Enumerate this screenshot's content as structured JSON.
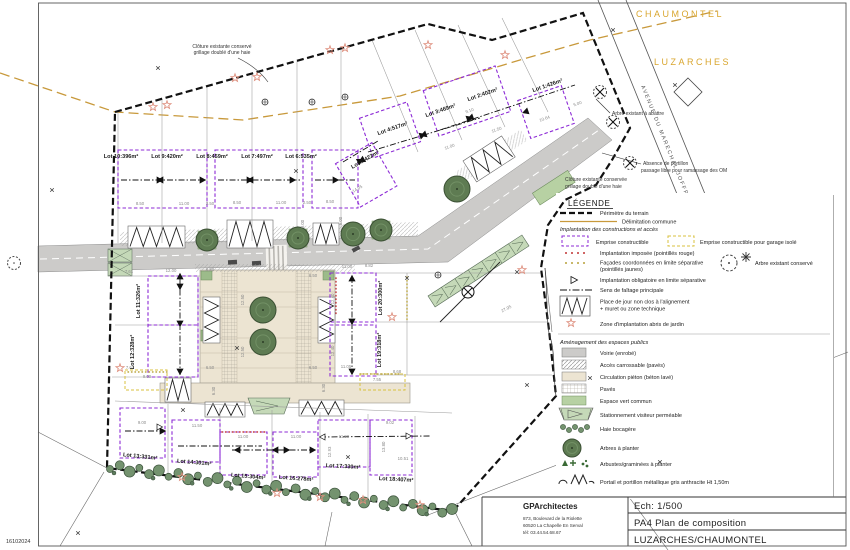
{
  "map": {
    "communes": {
      "north": "CHAUMONTEL",
      "south": "LUZARCHES"
    },
    "street": "AVENUE DU MARECHAL JOFFRE",
    "date_stamp": "16102024",
    "annotations": {
      "fence_nw_1": "Clôture existante conservé",
      "fence_nw_2": "grillage doublé d'une haie",
      "tree_fell": "Arbre existant à abattre",
      "bins_1": "Absence de portillon",
      "bins_2": "passage libre pour ramassage des OM",
      "fence_ne_1": "Clôture existante conservée",
      "fence_ne_2": "grillage doublé d'une haie"
    },
    "lots": [
      {
        "label": "Lot 1:426m²",
        "x": 548,
        "y": 87,
        "rot": -19
      },
      {
        "label": "Lot 2:402m²",
        "x": 483,
        "y": 96,
        "rot": -19
      },
      {
        "label": "Lot 3:469m²",
        "x": 441,
        "y": 112,
        "rot": -19
      },
      {
        "label": "Lot 4:517m²",
        "x": 393,
        "y": 130,
        "rot": -19
      },
      {
        "label": "Lot 5:422m²",
        "x": 366,
        "y": 161,
        "rot": -30
      },
      {
        "label": "Lot 6:535m²",
        "x": 301,
        "y": 158,
        "rot": 0
      },
      {
        "label": "Lot 7:497m²",
        "x": 257,
        "y": 158,
        "rot": 0
      },
      {
        "label": "Lot 8:459m²",
        "x": 212,
        "y": 158,
        "rot": 0
      },
      {
        "label": "Lot 9:420m²",
        "x": 167,
        "y": 158,
        "rot": 0
      },
      {
        "label": "Lot 10:396m²",
        "x": 121,
        "y": 158,
        "rot": 0
      },
      {
        "label": "Lot 11:326m²",
        "x": 140,
        "y": 301,
        "rot": -90
      },
      {
        "label": "Lot 12:328m²",
        "x": 134,
        "y": 352,
        "rot": -90
      },
      {
        "label": "Lot 13:331m²",
        "x": 140,
        "y": 458,
        "rot": 6
      },
      {
        "label": "Lot 14:301m²",
        "x": 194,
        "y": 464,
        "rot": 5
      },
      {
        "label": "Lot 15:304m²",
        "x": 248,
        "y": 478,
        "rot": 5
      },
      {
        "label": "Lot 16:278m²",
        "x": 296,
        "y": 480,
        "rot": 4
      },
      {
        "label": "Lot 17:330m²",
        "x": 343,
        "y": 468,
        "rot": 3
      },
      {
        "label": "Lot 18:407m²",
        "x": 396,
        "y": 481,
        "rot": 3
      },
      {
        "label": "Lot 19:318m²",
        "x": 381,
        "y": 350,
        "rot": -90
      },
      {
        "label": "Lot 20:300m²",
        "x": 382,
        "y": 298,
        "rot": -90
      }
    ],
    "dimensions": [
      {
        "t": "8.50",
        "x": 140,
        "y": 205
      },
      {
        "t": "11.00",
        "x": 184,
        "y": 205
      },
      {
        "t": "2.50",
        "x": 210,
        "y": 205
      },
      {
        "t": "8.50",
        "x": 237,
        "y": 204
      },
      {
        "t": "11.00",
        "x": 281,
        "y": 204
      },
      {
        "t": "2.50",
        "x": 307,
        "y": 204
      },
      {
        "t": "8.50",
        "x": 330,
        "y": 203
      },
      {
        "t": "5.00",
        "x": 304,
        "y": 224,
        "r": -90
      },
      {
        "t": "5.00",
        "x": 342,
        "y": 221,
        "r": -90
      },
      {
        "t": "11.00",
        "x": 450,
        "y": 148,
        "r": -19
      },
      {
        "t": "11.50",
        "x": 497,
        "y": 131,
        "r": -19
      },
      {
        "t": "9.10",
        "x": 470,
        "y": 112,
        "r": -19
      },
      {
        "t": "10.64",
        "x": 545,
        "y": 120,
        "r": -19
      },
      {
        "t": "14.05",
        "x": 358,
        "y": 190,
        "r": -30
      },
      {
        "t": "5.00",
        "x": 578,
        "y": 105,
        "r": -19
      },
      {
        "t": "7.61",
        "x": 129,
        "y": 273
      },
      {
        "t": "12.00",
        "x": 171,
        "y": 272
      },
      {
        "t": "6.50",
        "x": 210,
        "y": 271
      },
      {
        "t": "12.50",
        "x": 244,
        "y": 300,
        "r": -90
      },
      {
        "t": "12.50",
        "x": 244,
        "y": 352,
        "r": -90
      },
      {
        "t": "6.50",
        "x": 210,
        "y": 369
      },
      {
        "t": "7.61",
        "x": 130,
        "y": 369
      },
      {
        "t": "9.00",
        "x": 147,
        "y": 378
      },
      {
        "t": "6.30",
        "x": 215,
        "y": 391,
        "r": -90
      },
      {
        "t": "11.00",
        "x": 347,
        "y": 268
      },
      {
        "t": "8.82",
        "x": 369,
        "y": 267
      },
      {
        "t": "12.40",
        "x": 334,
        "y": 299,
        "r": -90
      },
      {
        "t": "12.40",
        "x": 334,
        "y": 351,
        "r": -90
      },
      {
        "t": "11.05",
        "x": 346,
        "y": 368
      },
      {
        "t": "7.55",
        "x": 377,
        "y": 381
      },
      {
        "t": "8.68",
        "x": 397,
        "y": 373
      },
      {
        "t": "27.95",
        "x": 507,
        "y": 310,
        "r": -28
      },
      {
        "t": "6.50",
        "x": 313,
        "y": 277
      },
      {
        "t": "6.50",
        "x": 313,
        "y": 369
      },
      {
        "t": "6.30",
        "x": 325,
        "y": 388,
        "r": -90
      },
      {
        "t": "9.00",
        "x": 142,
        "y": 424
      },
      {
        "t": "11.50",
        "x": 197,
        "y": 427
      },
      {
        "t": "11.00",
        "x": 243,
        "y": 438
      },
      {
        "t": "11.00",
        "x": 296,
        "y": 438
      },
      {
        "t": "11.99",
        "x": 344,
        "y": 438
      },
      {
        "t": "9.02",
        "x": 390,
        "y": 424
      },
      {
        "t": "10.51",
        "x": 403,
        "y": 460
      },
      {
        "t": "12.93",
        "x": 331,
        "y": 452,
        "r": -90
      },
      {
        "t": "13.80",
        "x": 385,
        "y": 447,
        "r": -90
      }
    ]
  },
  "legend": {
    "title": "LÉGENDE",
    "perimeter": "Périmètre du terrain",
    "commune": "Délimitation commune",
    "section1": "Implantation des constructions et accès",
    "emprise": "Emprise constructible",
    "emprise_garage": "Emprise constructible pour garage isolé",
    "imposee": "Implantation imposée (pointillés rouge)",
    "facades_1": "Façades coordonnées en limite séparative",
    "facades_2": "(pointillés jaunes)",
    "obligatoire": "Implantation obligatoire en limite séparative",
    "faitage": "Sens de faîtage principale",
    "place_jour_1": "Place de jour non clos à l'alignement",
    "place_jour_2": "+ muret ou zone technique",
    "abris": "Zone d'implantation abris de jardin",
    "arbre_conserve": "Arbre existant conservé",
    "section2": "Aménagement des espaces publics",
    "voirie": "Voirie (enrobé)",
    "acces": "Accès carrossable (pavés)",
    "pieton": "Circulation piéton (béton lavé)",
    "paves": "Pavés",
    "espace_vert": "Espace vert commun",
    "stationnement": "Stationnement visiteur perméable",
    "haie": "Haie bocagère",
    "arbres": "Arbres à planter",
    "arbustes": "Arbustes/graminées à planter",
    "portail": "Portail et portillon métallique gris anthracite Ht 1,50m"
  },
  "title_block": {
    "firm": "GPArchitectes",
    "address_1": "873, Boulevard de la Riolette",
    "address_2": "60520 La Chapelle En Serval",
    "address_3": "tél: 03.44.54.68.67",
    "scale": "Ech: 1/500",
    "sheet": "PA4 Plan de composition",
    "project": "LUZARCHES/CHAUMONTEL"
  },
  "colors": {
    "emprise_constructible": "#8d2bd6",
    "emprise_garage": "#d8c23f",
    "delimitation_commune": "#c8993b",
    "commune_labels": "#d9a62e",
    "abris_star": "#de8f7e",
    "espace_vert": "#b7d1a3",
    "arbre": "#5e7b52",
    "voirie": "#cccbc9",
    "circulation_pieton": "#ece4d2",
    "implantation_imposee": "#c23434"
  }
}
